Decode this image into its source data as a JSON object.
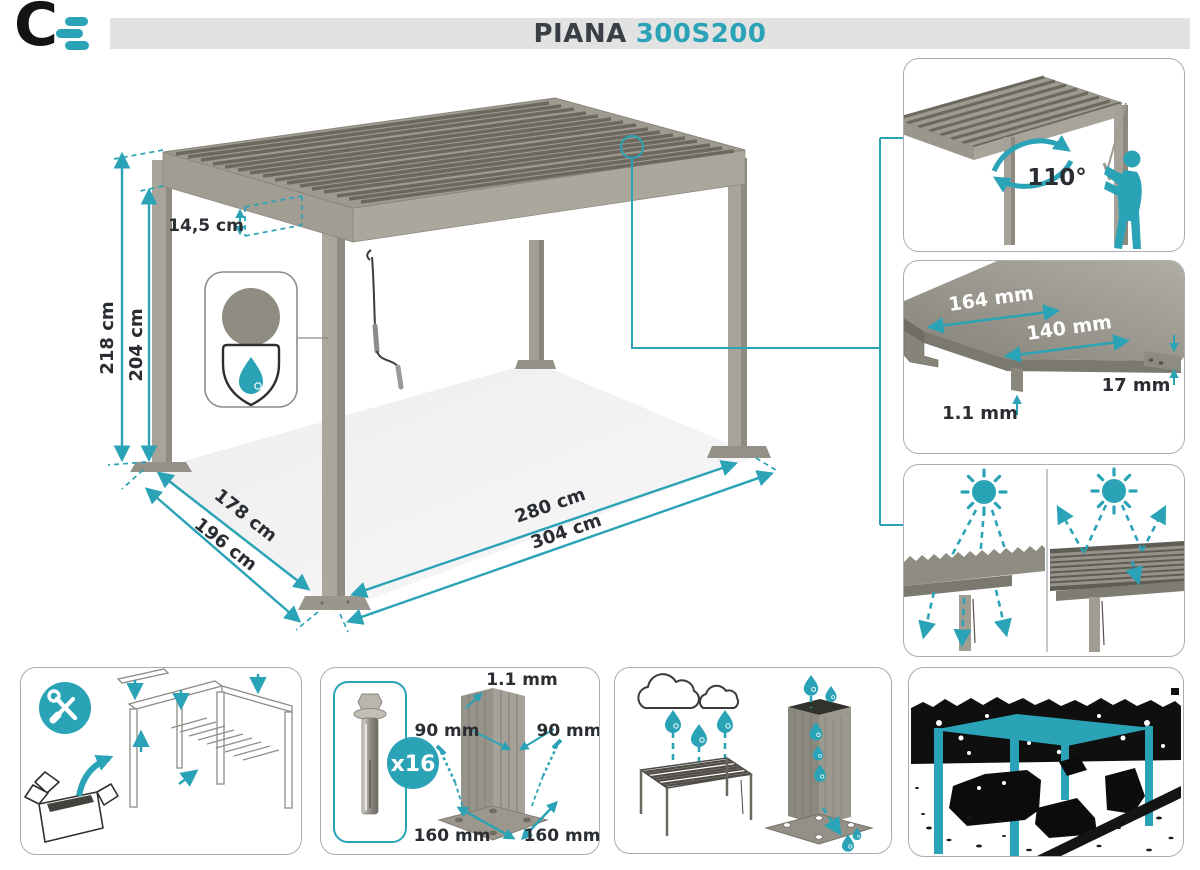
{
  "brand": {
    "logo_letter": "C"
  },
  "header": {
    "model": "PIANA",
    "variant": "300S200"
  },
  "main": {
    "height_total": "218 cm",
    "height_clearance": "204 cm",
    "roof_thickness": "14,5 cm",
    "depth_inner": "178 cm",
    "depth_outer": "196 cm",
    "width_inner": "280 cm",
    "width_outer": "304 cm"
  },
  "rotation_panel": {
    "angle": "110°"
  },
  "louvre_panel": {
    "outer_width": "164 mm",
    "inner_width": "140 mm",
    "edge_height": "17 mm",
    "thickness": "1.1 mm"
  },
  "anchor_panel": {
    "bolt_count": "x16",
    "wall_thickness": "1.1 mm",
    "post_side_left": "90 mm",
    "post_side_right": "90 mm",
    "base_side_left": "160 mm",
    "base_side_right": "160 mm"
  },
  "icons": {
    "logo": "brand-logo",
    "tools": "wrench-screwdriver",
    "shield": "water-resistant-shield",
    "sun": "sun",
    "drop": "water-drop",
    "rotation": "rotation-arrows"
  },
  "colors": {
    "accent": "#2BA3B7",
    "title_dark": "#3A3E45",
    "metal_gray": "#9C988E",
    "header_bar": "#E2E2E2"
  }
}
